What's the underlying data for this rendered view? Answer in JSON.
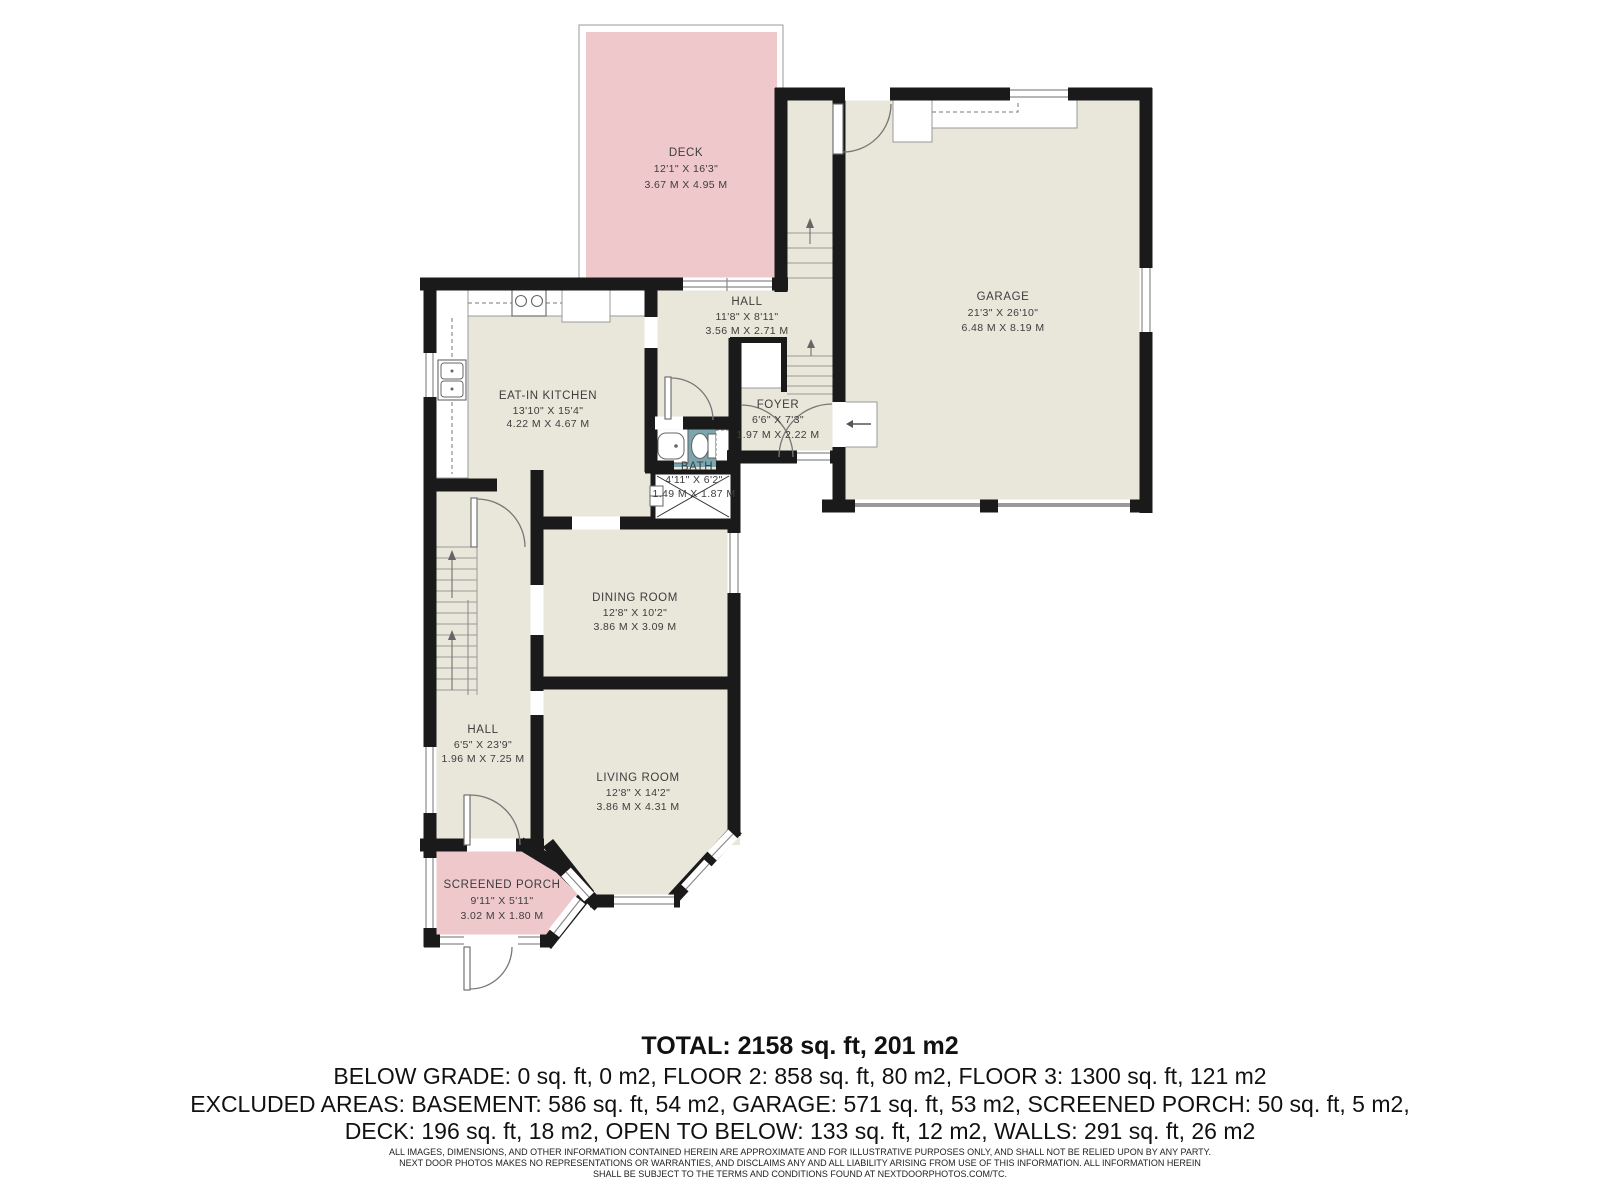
{
  "rooms": {
    "deck": {
      "name": "DECK",
      "imperial": "12'1\" X 16'3\"",
      "metric": "3.67 M X 4.95 M"
    },
    "garage": {
      "name": "GARAGE",
      "imperial": "21'3\" X 26'10\"",
      "metric": "6.48 M X 8.19 M"
    },
    "hall_upper": {
      "name": "HALL",
      "imperial": "11'8\" X 8'11\"",
      "metric": "3.56 M X 2.71 M"
    },
    "kitchen": {
      "name": "EAT-IN KITCHEN",
      "imperial": "13'10\" X 15'4\"",
      "metric": "4.22 M X 4.67 M"
    },
    "foyer": {
      "name": "FOYER",
      "imperial": "6'6\" X 7'3\"",
      "metric": "1.97 M X 2.22 M"
    },
    "bath": {
      "name": "BATH",
      "imperial": "4'11\" X 6'2\"",
      "metric": "1.49 M X 1.87 M"
    },
    "dining": {
      "name": "DINING ROOM",
      "imperial": "12'8\" X 10'2\"",
      "metric": "3.86 M X 3.09 M"
    },
    "hall_lower": {
      "name": "HALL",
      "imperial": "6'5\" X 23'9\"",
      "metric": "1.96 M X 7.25 M"
    },
    "living": {
      "name": "LIVING ROOM",
      "imperial": "12'8\" X 14'2\"",
      "metric": "3.86 M X 4.31 M"
    },
    "porch": {
      "name": "SCREENED PORCH",
      "imperial": "9'11\" X 5'11\"",
      "metric": "3.02 M X 1.80 M"
    }
  },
  "summary": {
    "total": "TOTAL: 2158 sq. ft, 201 m2",
    "line2": "BELOW GRADE: 0 sq. ft, 0 m2, FLOOR 2: 858 sq. ft, 80 m2, FLOOR 3: 1300 sq. ft, 121 m2",
    "line3": "EXCLUDED AREAS: BASEMENT: 586 sq. ft, 54 m2, GARAGE: 571 sq. ft, 53 m2, SCREENED PORCH: 50 sq. ft, 5 m2,",
    "line4": "DECK: 196 sq. ft, 18 m2, OPEN TO BELOW: 133 sq. ft, 12 m2, WALLS: 291 sq. ft, 26 m2"
  },
  "disclaimer": {
    "line1": "ALL IMAGES, DIMENSIONS, AND OTHER INFORMATION CONTAINED HEREIN ARE APPROXIMATE AND FOR ILLUSTRATIVE PURPOSES ONLY, AND SHALL NOT BE RELIED UPON BY ANY PARTY.",
    "line2": "NEXT DOOR PHOTOS MAKES NO REPRESENTATIONS OR WARRANTIES, AND DISCLAIMS ANY AND ALL LIABILITY ARISING FROM USE OF THIS INFORMATION. ALL INFORMATION HEREIN",
    "line3": "SHALL BE SUBJECT TO THE TERMS AND CONDITIONS FOUND AT NEXTDOORPHOTOS.COM/TC."
  },
  "colors": {
    "wall": "#1a1a1a",
    "floor": "#e9e6da",
    "deck_porch": "#efc8cc",
    "bath": "#7aa7af",
    "label": "#3d3d3d",
    "summary": "#111111"
  }
}
